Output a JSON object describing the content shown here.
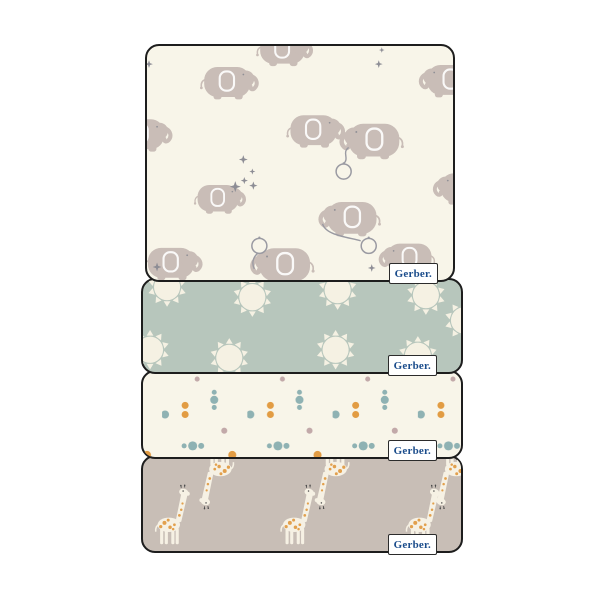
{
  "image_type": "product-photo of stacked baby flannel blankets",
  "background_color": "#ffffff",
  "badge": {
    "label": "Gerber.",
    "text_color": "#1a4c8b",
    "background": "#ffffff",
    "border_color": "#2b2b2b"
  },
  "panels": [
    {
      "id": "elephants",
      "description": "Cream blanket with gray elephants holding balloons and small gray stars",
      "background": "#f8f5e9",
      "motif_color": "#c9bdb7",
      "accent_color": "#8d8d95"
    },
    {
      "id": "suns",
      "description": "Sage green blanket with cream suns",
      "background": "#b7c6bc",
      "motif_color": "#f5f1e3"
    },
    {
      "id": "dots",
      "description": "Cream blanket with teal, orange and mauve dots",
      "background": "#f8f5e9",
      "dot_colors": [
        "#8fb2b3",
        "#e29c43",
        "#c2a9a9"
      ]
    },
    {
      "id": "giraffes",
      "description": "Taupe blanket with cream giraffes with orange spots, alternating upright and inverted",
      "background": "#c8beb6",
      "motif_color": "#f6f1e4",
      "spot_color": "#e2a04d"
    }
  ]
}
